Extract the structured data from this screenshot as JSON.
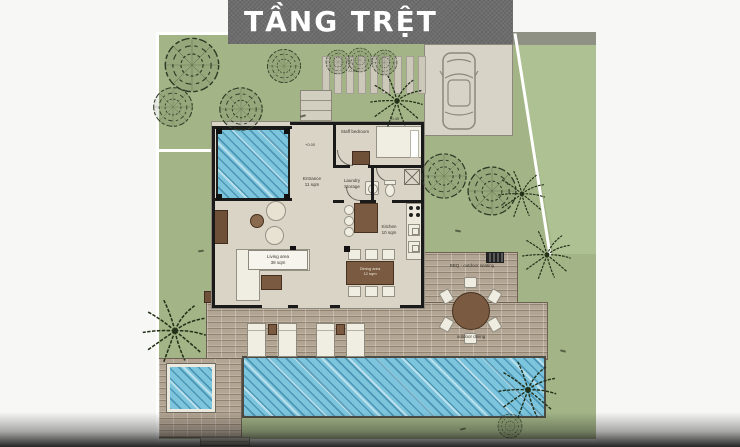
{
  "title": "TẦNG TRỆT",
  "rooms": {
    "staff_bedroom": "Staff bedroom",
    "entrance": "Entrance",
    "entrance_area": "11 sqm",
    "laundry1": "Laundry",
    "laundry2": "Storage",
    "kitchen": "Kitchen",
    "kitchen_area": "10 sqm",
    "living": "Living area",
    "living_area": "38 sqm",
    "dining": "Dining area",
    "dining_area": "12 sqm"
  },
  "outdoor": {
    "bbq": "BBQ - outdoor seating",
    "dining": "outdoor dining"
  },
  "markers": {
    "zero": "+0.00",
    "minus": "-0.45"
  },
  "colors": {
    "grass": "#a3b587",
    "grass_neighbor": "#aec193",
    "banner": "#6d6d6d",
    "water": "#7cc5dd",
    "deck_wood": "#b3a593",
    "floor": "#d9d4c6",
    "wall": "#1a1a1a",
    "furniture_wood": "#7a5a40",
    "furniture_white": "#f0ede3",
    "title_text": "#ffffff"
  }
}
